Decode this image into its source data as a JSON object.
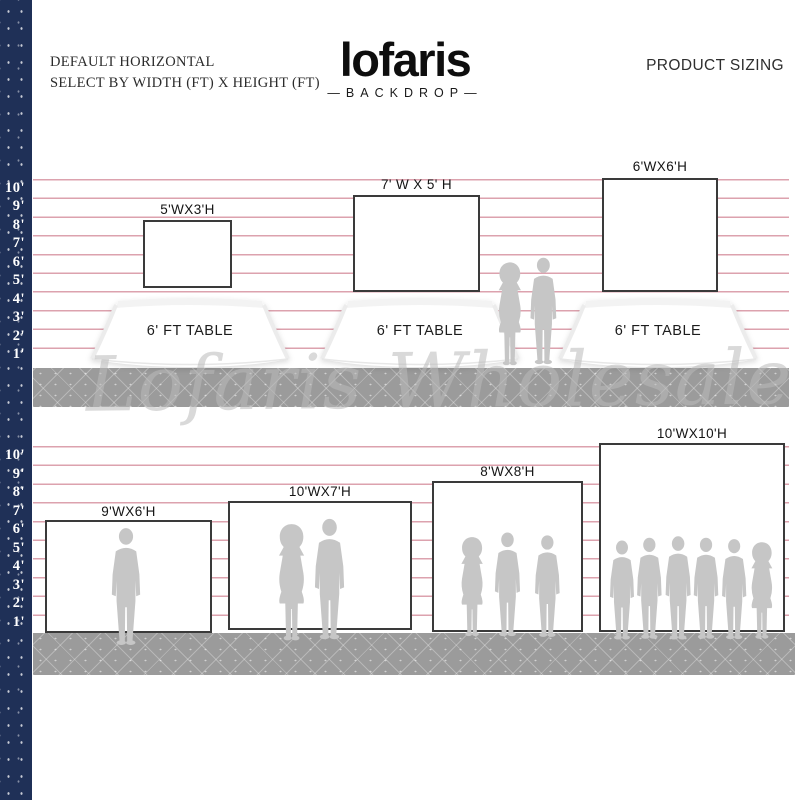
{
  "header": {
    "instruction_line1": "DEFAULT HORIZONTAL",
    "instruction_line2": "SELECT BY WIDTH (FT) X HEIGHT (FT)",
    "product_label": "PRODUCT SIZING"
  },
  "brand": {
    "logo": "lofaris",
    "tagline": "—BACKDROP—"
  },
  "watermark": "Lofaris Wholesale",
  "ruler_marks": [
    "10'",
    "9'",
    "8'",
    "7'",
    "6'",
    "5'",
    "4'",
    "3'",
    "2'",
    "1'"
  ],
  "top_row": {
    "table_label": "6' FT TABLE",
    "backdrops": [
      {
        "size": "5'WX3'H"
      },
      {
        "size": "7' W X 5' H"
      },
      {
        "size": "6'WX6'H"
      }
    ]
  },
  "bottom_row": {
    "backdrops": [
      {
        "size": "9'WX6'H"
      },
      {
        "size": "10'WX7'H"
      },
      {
        "size": "8'WX8'H"
      },
      {
        "size": "10'WX10'H"
      }
    ]
  },
  "colors": {
    "navy_strip": "#1f3057",
    "guide_line": "#dca2ae",
    "floor": "#9b9b9b",
    "silhouette": "#c6c6c6",
    "panel_border": "#3a3a3a"
  }
}
